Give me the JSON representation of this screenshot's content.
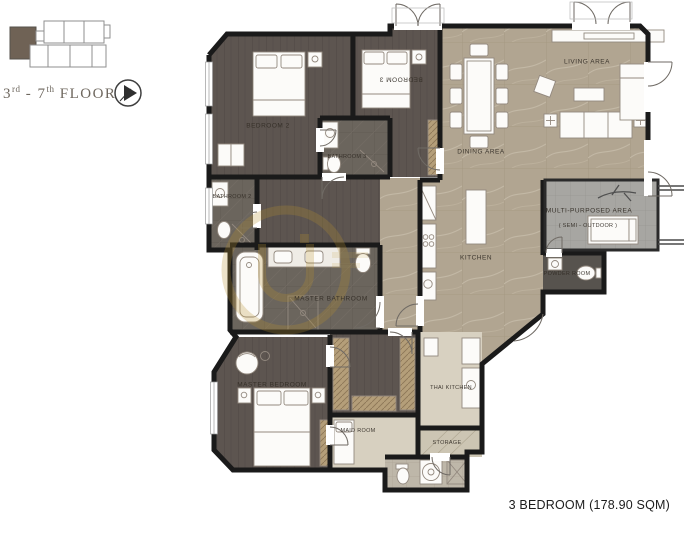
{
  "key_plan": {
    "floor_prefix": "3",
    "floor_prefix_sup": "rd",
    "floor_mid": " - 7",
    "floor_mid_sup": "th",
    "floor_suffix": " FLOOR",
    "compass_icon": "north-arrow-icon",
    "highlight_unit_color": "#6f6255"
  },
  "rooms": [
    {
      "id": "bedroom2",
      "label": "BEDROOM 2"
    },
    {
      "id": "bedroom3",
      "label": "BEDROOM 3"
    },
    {
      "id": "bathroom3",
      "label": "BATHROOM 3"
    },
    {
      "id": "bathroom2",
      "label": "BATHROOM 2"
    },
    {
      "id": "master_bathroom",
      "label": "MASTER BATHROOM"
    },
    {
      "id": "master_bedroom",
      "label": "MASTER BEDROOM"
    },
    {
      "id": "maid_room",
      "label": "MAID ROOM"
    },
    {
      "id": "storage",
      "label": "STORAGE"
    },
    {
      "id": "thai_kitchen",
      "label": "THAI KITCHEN"
    },
    {
      "id": "kitchen",
      "label": "KITCHEN"
    },
    {
      "id": "dining",
      "label": "DINING AREA"
    },
    {
      "id": "living",
      "label": "LIVING AREA"
    },
    {
      "id": "multi_purpose",
      "label": "MULTI-PURPOSED AREA",
      "sub_label": "( SEMI - OUTDOOR )"
    },
    {
      "id": "powder",
      "label": "POWDER ROOM"
    }
  ],
  "unit_info": {
    "label": "3 BEDROOM (178.90 SQM)"
  },
  "colors": {
    "wall": "#1a1a1a",
    "wood_floor": "#5d5550",
    "tile_floor": "#6b655d",
    "marble_floor": "#b1a591",
    "outdoor_floor": "#a7a6a2",
    "powder_floor": "#57534e",
    "watermark_gold": "#b8912f"
  }
}
